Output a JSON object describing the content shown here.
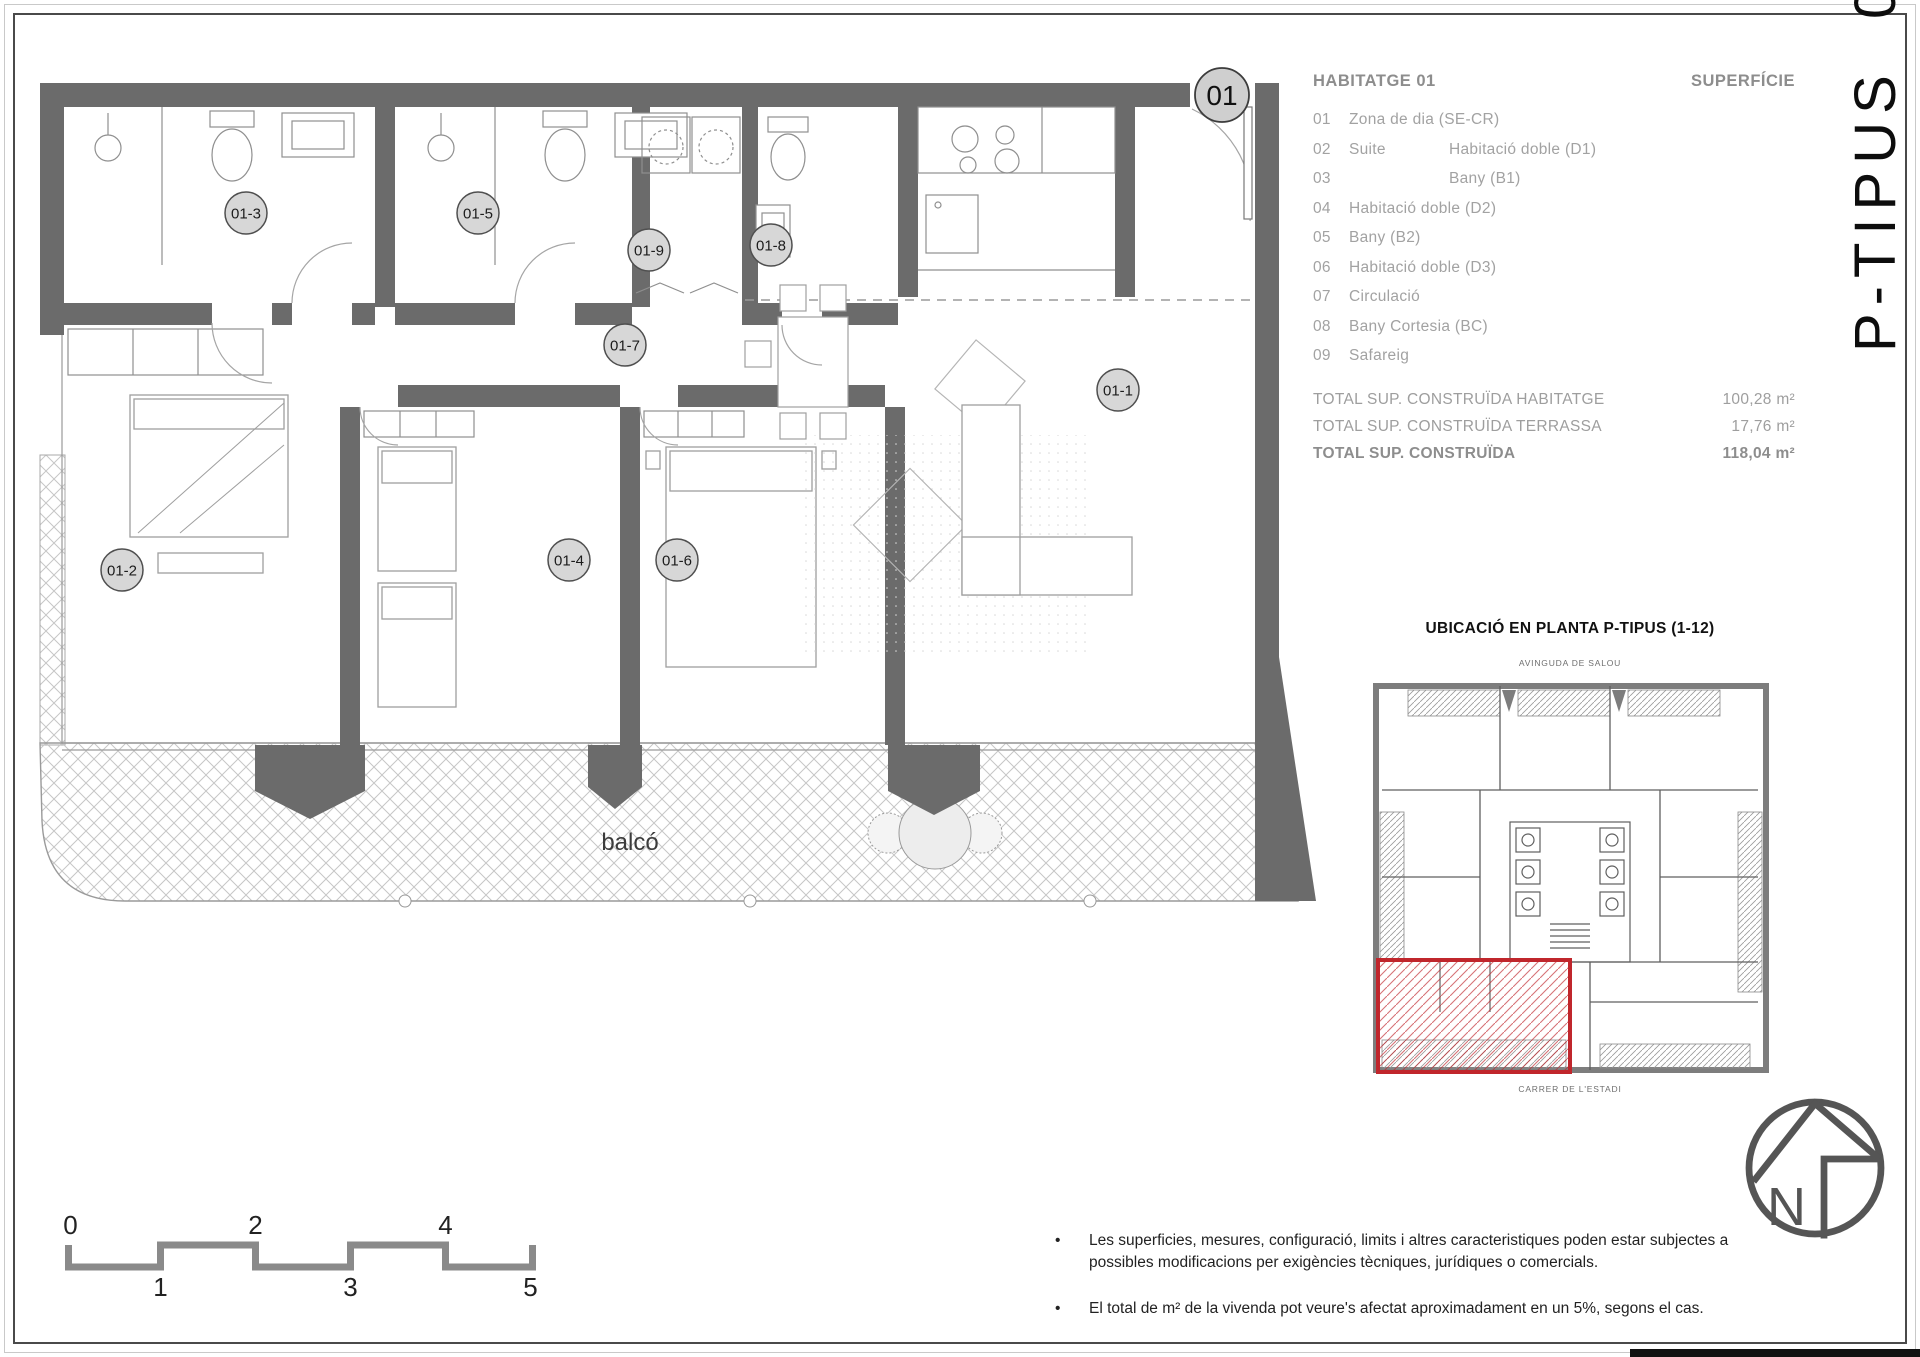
{
  "sheet": {
    "vertical_title": "P-TIPUS  01",
    "entry_badge": "01"
  },
  "plan": {
    "tags": [
      "01-1",
      "01-2",
      "01-3",
      "01-4",
      "01-5",
      "01-6",
      "01-7",
      "01-8",
      "01-9"
    ],
    "balco_label": "balcó"
  },
  "legend": {
    "title": "HABITATGE 01",
    "superficie_header": "SUPERFÍCIE",
    "items": [
      {
        "num": "01",
        "col1": "Zona de dia (SE-CR)",
        "col2": ""
      },
      {
        "num": "02",
        "col1": "Suite",
        "col2": "Habitació doble (D1)"
      },
      {
        "num": "03",
        "col1": "",
        "col2": "Bany (B1)"
      },
      {
        "num": "04",
        "col1": "Habitació doble (D2)",
        "col2": ""
      },
      {
        "num": "05",
        "col1": "Bany (B2)",
        "col2": ""
      },
      {
        "num": "06",
        "col1": "Habitació doble (D3)",
        "col2": ""
      },
      {
        "num": "07",
        "col1": "Circulació",
        "col2": ""
      },
      {
        "num": "08",
        "col1": "Bany Cortesia (BC)",
        "col2": ""
      },
      {
        "num": "09",
        "col1": "Safareig",
        "col2": ""
      }
    ],
    "totals": [
      {
        "label": "TOTAL SUP. CONSTRUÏDA HABITATGE",
        "value": "100,28 m²"
      },
      {
        "label": "TOTAL SUP. CONSTRUÏDA TERRASSA",
        "value": "17,76 m²"
      },
      {
        "label": "TOTAL SUP. CONSTRUÏDA",
        "value": "118,04 m²"
      }
    ]
  },
  "location": {
    "title": "UBICACIÓ EN PLANTA P-TIPUS (1-12)",
    "street_top": "AVINGUDA DE SALOU",
    "street_bottom": "CARRER DE L'ESTADI"
  },
  "north": {
    "label": "N"
  },
  "scalebar": {
    "labels_top": [
      "0",
      "2",
      "4"
    ],
    "labels_bottom": [
      "1",
      "3",
      "5"
    ]
  },
  "notes": [
    "Les superficies, mesures, configuració, limits i altres caracteristiques poden estar subjectes a possibles modificacions per exigències tècniques, jurídiques o comercials.",
    "El total de m² de la vivenda pot veure's afectat aproximadament en un 5%, segons el cas."
  ],
  "colors": {
    "wall_gray": "#6b6b6b",
    "highlight_red": "#c0262c",
    "legend_gray": "#9e9e9e"
  }
}
